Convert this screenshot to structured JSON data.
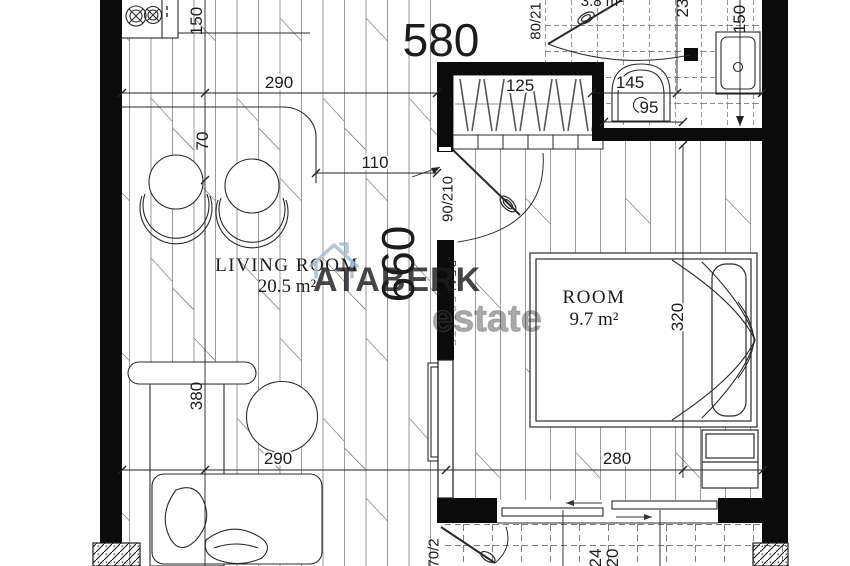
{
  "watermark": {
    "brand": "ATABERK",
    "tag_vertical": "REAL",
    "tag_vertical2": "ESTATE",
    "ghost_text": "estate",
    "brand_color": "#9cb9d3"
  },
  "rooms": {
    "living": {
      "name": "LIVING ROOM",
      "area": "20.5 m²"
    },
    "bedroom": {
      "name": "ROOM",
      "area": "9.7 m²"
    },
    "bathroom": {
      "area_partial": "3.8 m²"
    }
  },
  "dims": {
    "top_total": "580",
    "left_total": "660",
    "kitchen_top": "290",
    "kitchen_left": "150",
    "stool_gap": "70",
    "hall": "110",
    "wardrobe": "125",
    "bath_width": "145",
    "bath_inner": "95",
    "bath_right": "150",
    "bath_cut": "23",
    "living_bottom": "290",
    "living_height": "380",
    "bedroom_bottom": "280",
    "bedroom_height": "320",
    "balcony_cut_a": "24",
    "balcony_cut_b": "20"
  },
  "doors": {
    "bedroom_door": "90/210",
    "bath_door": "80/21",
    "balcony_door": "70/2"
  },
  "colors": {
    "wall": "#0b0b0b",
    "line": "#2a2a2a",
    "floor_line": "#8f8f8f",
    "watermark_blue": "#9cb9d3"
  }
}
